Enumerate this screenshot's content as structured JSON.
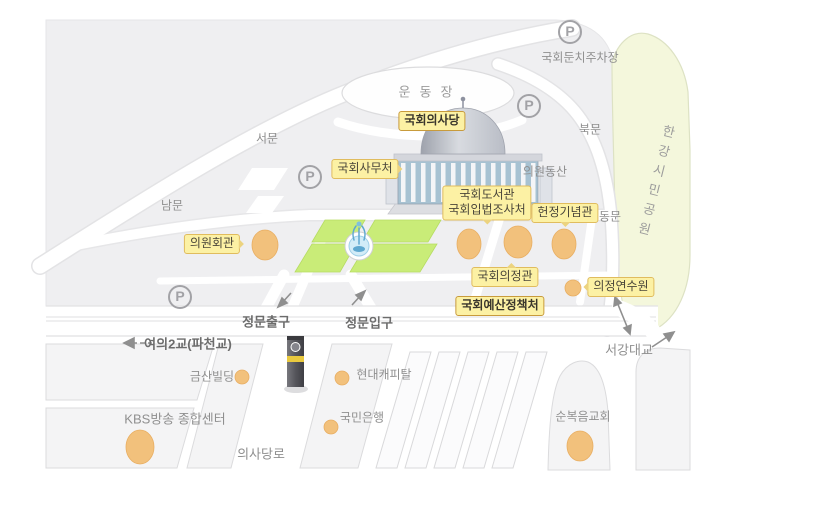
{
  "parking_symbol": "P",
  "colors": {
    "base_gray": "#EFEFF1",
    "road_white": "#FFFFFF",
    "park_green": "#F4F7DC",
    "lawn_green": "#C9EC78",
    "label_yellow": "#FCF1A4",
    "label_border": "#E0BC5E",
    "marker_orange": "#F2C17C",
    "text_gray": "#8F8F8F"
  },
  "gates": {
    "west": "서문",
    "south": "남문",
    "north": "북문",
    "east": "동문"
  },
  "facilities": {
    "assembly_hall": "국회의사당",
    "secretariat": "국회사무처",
    "members_hall": "의원회관",
    "library": "국회도서관",
    "legislation_office": "국회입법조사처",
    "memorial_hall": "헌정기념관",
    "uijeong_hall": "국회의정관",
    "budget_office": "국회예산정책처",
    "training_institute": "의정연수원"
  },
  "places": {
    "playground": "운동장",
    "members_hill": "의원동산",
    "riverside_parking": "국회둔치주차장",
    "han_river_park": "한강시민공원",
    "main_gate_exit": "정문출구",
    "main_gate_entrance": "정문입구",
    "yeoui_bridge": "여의2교(파천교)",
    "geumsan_building": "금산빌딩",
    "hyundai_capital": "현대캐피탈",
    "kbs_center": "KBS방송 종합센터",
    "kookmin_bank": "국민은행",
    "uisadang_road": "의사당로",
    "full_gospel_church": "순복음교회",
    "seogang_bridge": "서강대교"
  }
}
